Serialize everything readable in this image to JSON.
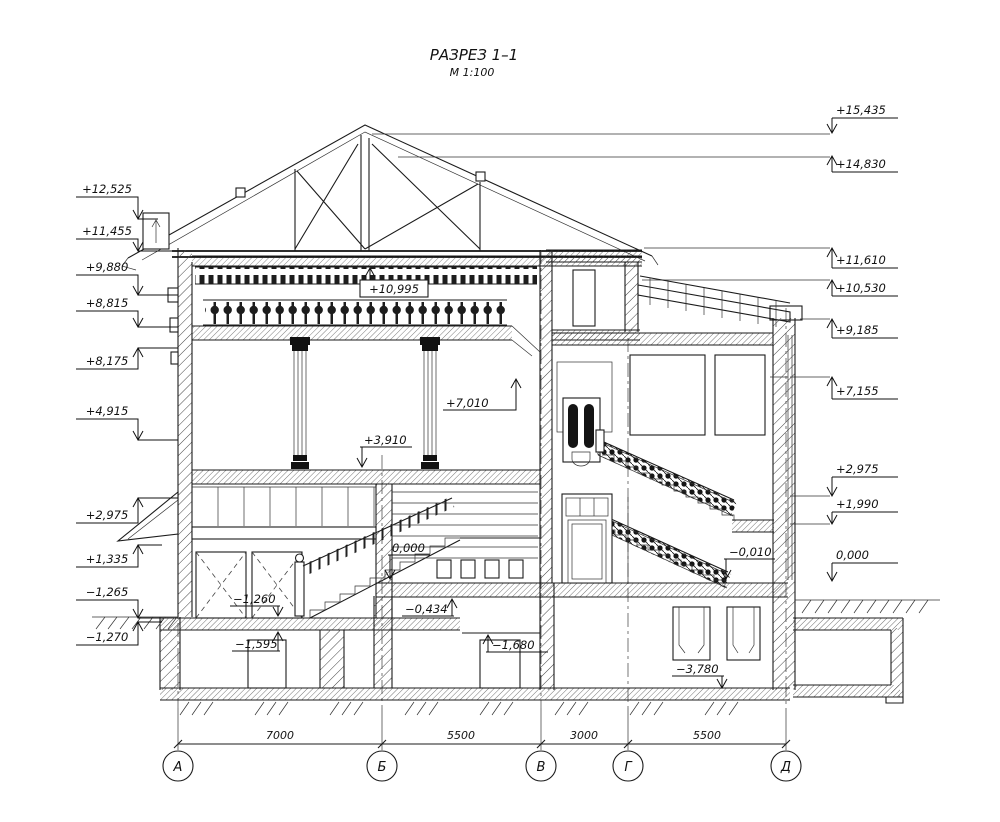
{
  "title": {
    "name": "РАЗРЕЗ 1–1",
    "scale": "М 1:100"
  },
  "elevation_marks": {
    "left": [
      {
        "label": "+12,525"
      },
      {
        "label": "+11,455"
      },
      {
        "label": "+9,880"
      },
      {
        "label": "+8,815"
      },
      {
        "label": "+8,175"
      },
      {
        "label": "+4,915"
      },
      {
        "label": "+2,975"
      },
      {
        "label": "+1,335"
      },
      {
        "label": "−1,265"
      },
      {
        "label": "−1,270"
      }
    ],
    "right": [
      {
        "label": "+15,435"
      },
      {
        "label": "+14,830"
      },
      {
        "label": "+11,610"
      },
      {
        "label": "+10,530"
      },
      {
        "label": "+9,185"
      },
      {
        "label": "+7,155"
      },
      {
        "label": "+2,975"
      },
      {
        "label": "+1,990"
      },
      {
        "label": "0,000"
      }
    ],
    "interior": [
      {
        "label": "+10,995"
      },
      {
        "label": "+7,010"
      },
      {
        "label": "+3,910"
      },
      {
        "label": "0,000"
      },
      {
        "label": "−0,010"
      },
      {
        "label": "−0,434"
      },
      {
        "label": "−1,260"
      },
      {
        "label": "−1,595"
      },
      {
        "label": "−1,680"
      },
      {
        "label": "−3,780"
      }
    ]
  },
  "axes": {
    "labels": [
      "А",
      "Б",
      "В",
      "Г",
      "Д"
    ]
  },
  "dimensions": {
    "values": [
      "7000",
      "5500",
      "3000",
      "5500"
    ]
  }
}
